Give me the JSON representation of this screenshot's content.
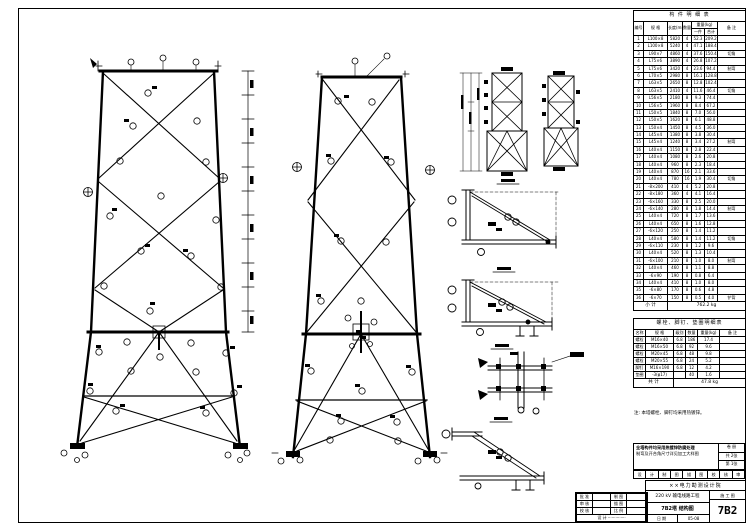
{
  "bom": {
    "title": "构 件 明 细 表",
    "headers": {
      "no": "编号",
      "spec": "规 格",
      "len": "长度(mm)",
      "qty": "数量",
      "weight": "重量(kg)",
      "one": "一件",
      "total": "合计",
      "remark": "备 注"
    },
    "rows": [
      [
        "1",
        "L100×8",
        "5820",
        "4",
        "52.3",
        "209.2",
        ""
      ],
      [
        "2",
        "L100×8",
        "5240",
        "4",
        "47.1",
        "188.4",
        ""
      ],
      [
        "3",
        "L90×7",
        "4860",
        "4",
        "37.6",
        "150.4",
        "切角"
      ],
      [
        "4",
        "L75×6",
        "3890",
        "4",
        "26.8",
        "107.2",
        ""
      ],
      [
        "5",
        "L75×6",
        "3420",
        "4",
        "23.6",
        "94.4",
        "制弯"
      ],
      [
        "6",
        "L70×5",
        "2980",
        "8",
        "16.1",
        "128.8",
        ""
      ],
      [
        "7",
        "L63×5",
        "2650",
        "8",
        "12.8",
        "102.4",
        ""
      ],
      [
        "8",
        "L63×5",
        "2410",
        "4",
        "11.6",
        "46.4",
        "切角"
      ],
      [
        "9",
        "L56×5",
        "2180",
        "8",
        "9.3",
        "74.4",
        ""
      ],
      [
        "10",
        "L56×5",
        "1960",
        "8",
        "8.4",
        "67.2",
        ""
      ],
      [
        "11",
        "L50×5",
        "1840",
        "8",
        "7.0",
        "56.0",
        ""
      ],
      [
        "12",
        "L50×5",
        "1620",
        "8",
        "6.1",
        "48.8",
        ""
      ],
      [
        "13",
        "L50×4",
        "1450",
        "8",
        "4.5",
        "36.0",
        ""
      ],
      [
        "14",
        "L45×4",
        "1380",
        "8",
        "3.8",
        "30.4",
        ""
      ],
      [
        "15",
        "L45×4",
        "1240",
        "8",
        "3.4",
        "27.2",
        "制弯"
      ],
      [
        "16",
        "L40×4",
        "1150",
        "8",
        "2.8",
        "22.4",
        ""
      ],
      [
        "17",
        "L40×4",
        "1080",
        "8",
        "2.6",
        "20.8",
        ""
      ],
      [
        "18",
        "L40×4",
        "960",
        "8",
        "2.3",
        "18.4",
        ""
      ],
      [
        "19",
        "L40×4",
        "870",
        "16",
        "2.1",
        "33.6",
        ""
      ],
      [
        "20",
        "L40×4",
        "780",
        "16",
        "1.9",
        "30.4",
        "切角"
      ],
      [
        "21",
        "-8×200",
        "410",
        "4",
        "5.2",
        "20.8",
        ""
      ],
      [
        "22",
        "-8×180",
        "360",
        "4",
        "4.1",
        "16.4",
        ""
      ],
      [
        "23",
        "-6×160",
        "330",
        "8",
        "2.5",
        "20.0",
        ""
      ],
      [
        "24",
        "-6×140",
        "280",
        "8",
        "1.8",
        "14.4",
        "制弯"
      ],
      [
        "25",
        "L40×4",
        "720",
        "8",
        "1.7",
        "13.6",
        ""
      ],
      [
        "26",
        "L40×4",
        "650",
        "8",
        "1.6",
        "12.8",
        ""
      ],
      [
        "27",
        "-6×120",
        "250",
        "8",
        "1.4",
        "11.2",
        ""
      ],
      [
        "28",
        "L40×4",
        "580",
        "8",
        "1.4",
        "11.2",
        "切角"
      ],
      [
        "29",
        "-6×110",
        "230",
        "8",
        "1.2",
        "9.6",
        ""
      ],
      [
        "30",
        "L40×4",
        "520",
        "8",
        "1.3",
        "10.4",
        ""
      ],
      [
        "31",
        "-6×100",
        "210",
        "8",
        "1.0",
        "8.0",
        "制弯"
      ],
      [
        "32",
        "L40×4",
        "460",
        "8",
        "1.1",
        "8.8",
        ""
      ],
      [
        "33",
        "-6×90",
        "190",
        "8",
        "0.8",
        "6.4",
        ""
      ],
      [
        "34",
        "L40×4",
        "410",
        "8",
        "1.0",
        "8.0",
        ""
      ],
      [
        "35",
        "-6×80",
        "170",
        "8",
        "0.6",
        "4.8",
        ""
      ],
      [
        "36",
        "-6×70",
        "150",
        "8",
        "0.5",
        "4.0",
        "铲背"
      ]
    ],
    "total_label": "小 计",
    "total_value": "762.2 kg"
  },
  "bolts": {
    "title": "螺栓、脚钉、垫圈明细表",
    "headers": [
      "名称",
      "规 格",
      "级别",
      "数量",
      "重量(kg)",
      "备 注"
    ],
    "rows": [
      [
        "螺栓",
        "M16×40",
        "6.8",
        "186",
        "17.4",
        ""
      ],
      [
        "螺栓",
        "M16×50",
        "6.8",
        "92",
        "9.6",
        ""
      ],
      [
        "螺栓",
        "M20×45",
        "6.8",
        "48",
        "9.8",
        ""
      ],
      [
        "螺栓",
        "M20×55",
        "6.8",
        "24",
        "5.2",
        ""
      ],
      [
        "脚钉",
        "M16×190",
        "6.8",
        "12",
        "4.2",
        ""
      ],
      [
        "垫圈",
        "-3(φ17)",
        "",
        "40",
        "1.6",
        ""
      ]
    ],
    "total_label": "共 计",
    "total_value": "47.8 kg"
  },
  "general_note": "注: 本塔螺栓、脚钉均采用热镀锌。",
  "notes_box": {
    "lines": [
      "全塔构件均采用热镀锌防腐处理",
      "制弯及开合角尺寸详见加工大样图"
    ],
    "pages": [
      "卷 册",
      "共 2张",
      "第 1张"
    ]
  },
  "strip_cells": [
    "设",
    "计",
    "制",
    "图",
    "描",
    "图",
    "校",
    "核",
    "审"
  ],
  "title_block": {
    "org": "××电力勘测设计院",
    "project": "220 kV 输电线路工程",
    "drawing": "7B2塔 结构图",
    "stage": "施 工 图",
    "number": "7B2",
    "date_label": "日 期",
    "date_value": "05-08",
    "signatures": [
      [
        "批 准",
        "",
        "制 图",
        ""
      ],
      [
        "审 核",
        "",
        "描 图",
        ""
      ],
      [
        "校 核",
        "",
        "比 例",
        ""
      ]
    ],
    "designer_row": "设 计 ··············"
  }
}
